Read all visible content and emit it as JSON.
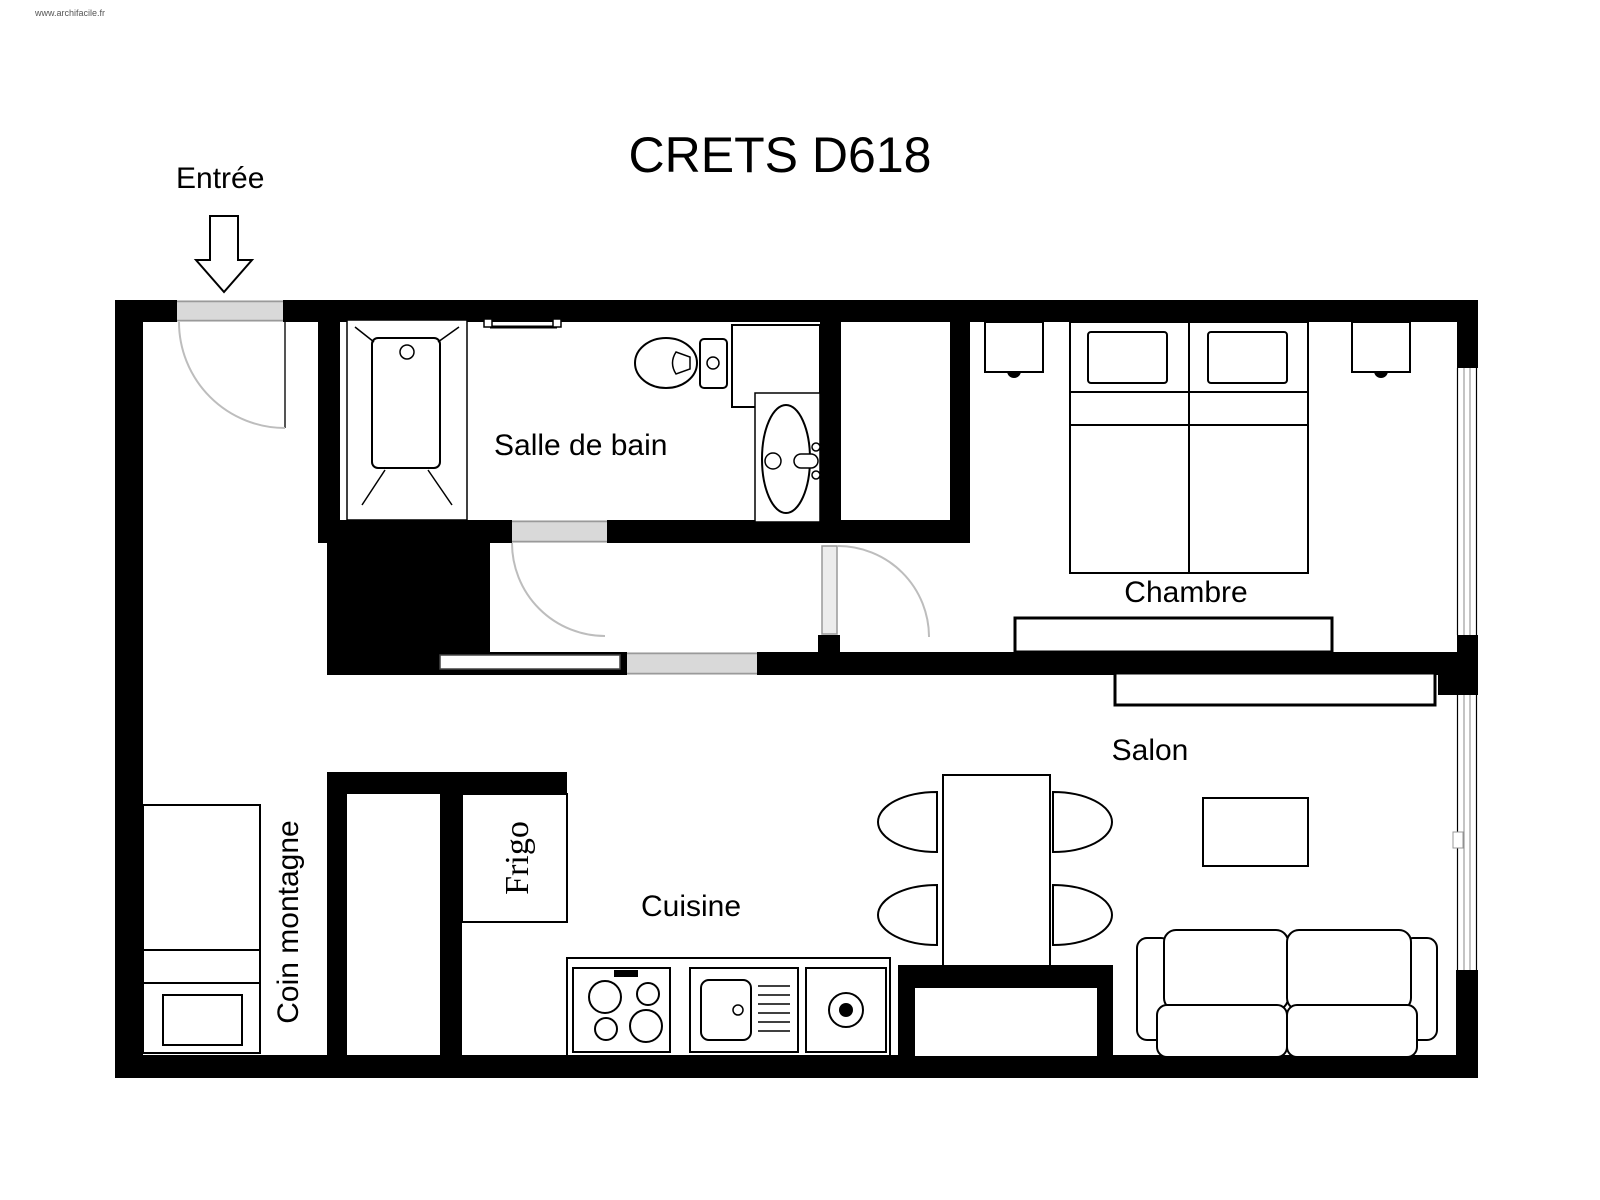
{
  "watermark": "www.archifacile.fr",
  "title": "CRETS D618",
  "rooms": {
    "entrance_label": "Entrée",
    "bathroom_label": "Salle de bain",
    "bedroom_label": "Chambre",
    "living_room_label": "Salon",
    "kitchen_label": "Cuisine",
    "mountain_corner_label": "Coin montagne"
  },
  "appliances": {
    "fridge_label": "Frigo"
  },
  "colors": {
    "walls": "#000000",
    "background": "#ffffff",
    "door_opening": "#d9d9d9",
    "door_arc": "#bdbdbd",
    "furniture_outline": "#000000"
  }
}
